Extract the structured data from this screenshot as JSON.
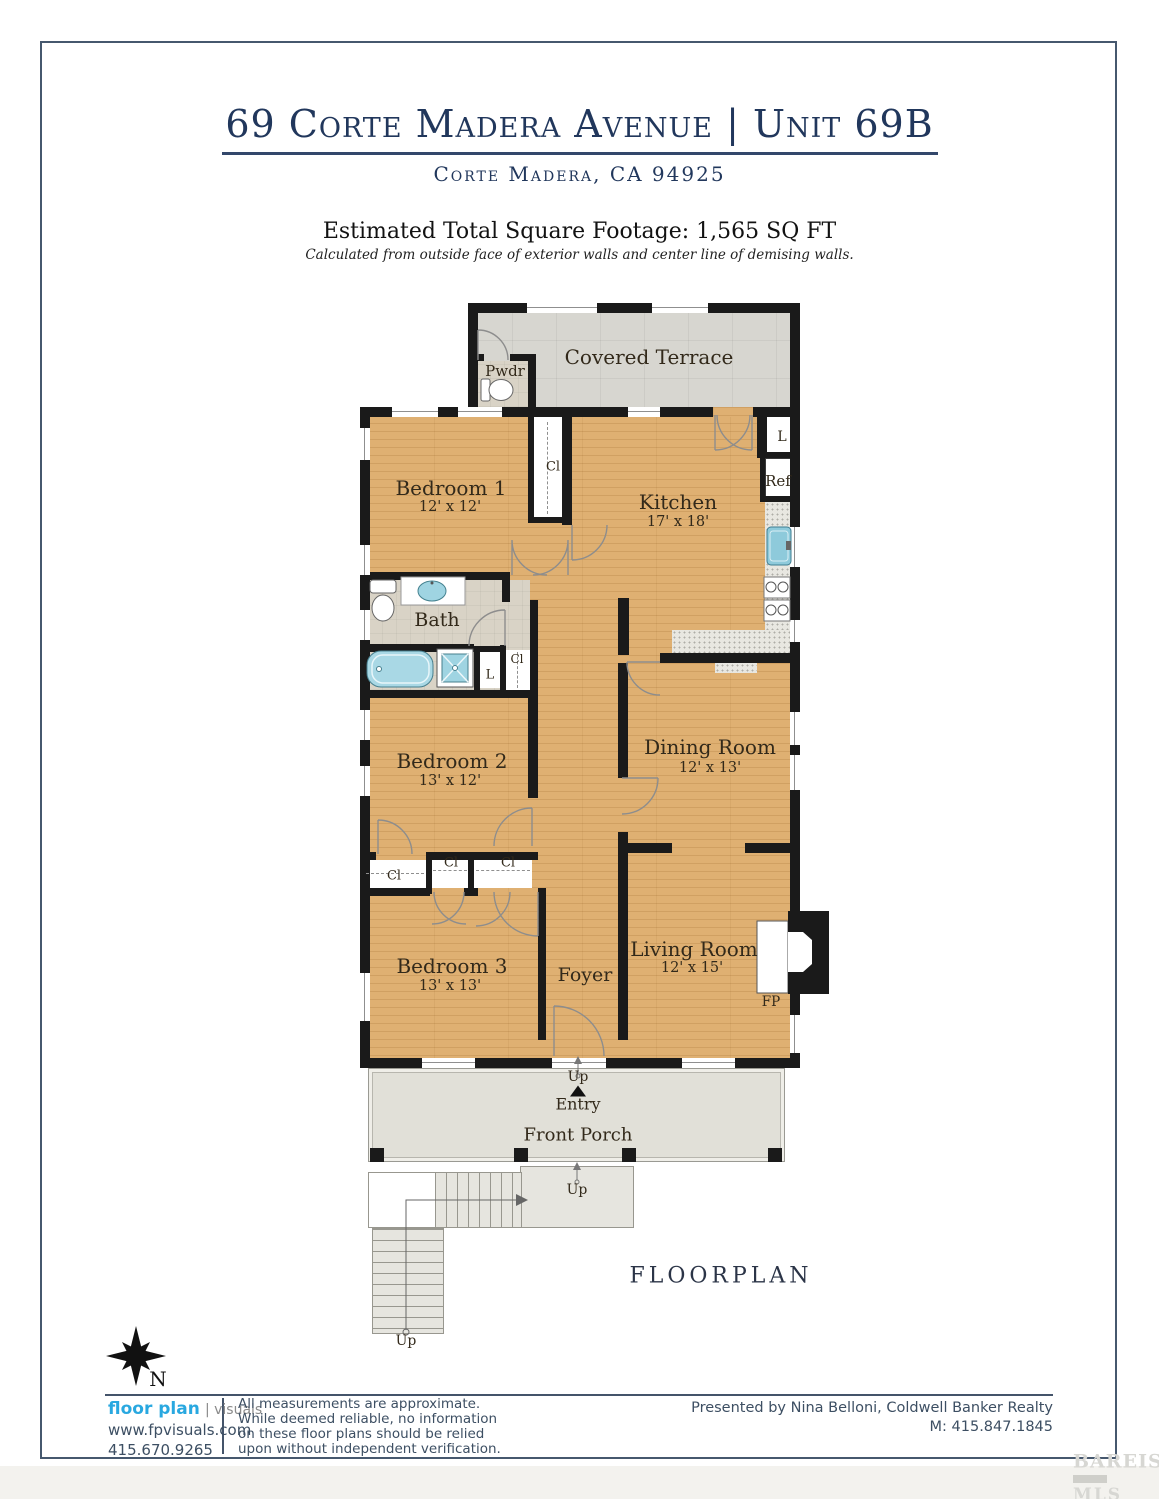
{
  "header": {
    "title": "69 Corte Madera Avenue | Unit 69B",
    "subtitle": "Corte Madera, CA 94925",
    "sqft_line": "Estimated Total Square Footage: 1,565 SQ FT",
    "sqft_note": "Calculated from outside face of exterior walls and center line of demising walls."
  },
  "plan": {
    "rooms": {
      "covered_terrace": {
        "name": "Covered Terrace"
      },
      "pwdr": {
        "name": "Pwdr"
      },
      "bedroom1": {
        "name": "Bedroom 1",
        "dims": "12' x 12'"
      },
      "kitchen": {
        "name": "Kitchen",
        "dims": "17' x 18'"
      },
      "bath": {
        "name": "Bath"
      },
      "bedroom2": {
        "name": "Bedroom 2",
        "dims": "13' x 12'"
      },
      "dining_room": {
        "name": "Dining Room",
        "dims": "12' x 13'"
      },
      "bedroom3": {
        "name": "Bedroom 3",
        "dims": "13' x 13'"
      },
      "foyer": {
        "name": "Foyer"
      },
      "living_room": {
        "name": "Living Room",
        "dims": "12' x 15'"
      },
      "front_porch": {
        "name": "Front Porch"
      }
    },
    "small_labels": {
      "closet": "Cl",
      "linen": "L",
      "refrigerator": "Ref",
      "fireplace": "FP",
      "up": "Up",
      "entry": "Entry"
    },
    "caption": "FLOORPLAN",
    "compass_north": "N",
    "colors": {
      "wood_floor": "#dfb072",
      "terrace_tile": "#d7d6d0",
      "bath_tile": "#d9d3c6",
      "fixture_blue": "#9fd4e2",
      "wall": "#1a1a1a"
    }
  },
  "footer": {
    "brand": {
      "name_bold": "floor plan",
      "name_light": "visuals",
      "website": "www.fpvisuals.com",
      "phone": "415.670.9265",
      "brand_blue": "#29a8e0"
    },
    "disclaimer": [
      "All measurements are approximate.",
      "While deemed reliable, no information",
      "on these floor plans should be relied",
      "upon without independent verification."
    ],
    "presented_by": "Presented by Nina Belloni, Coldwell Banker Realty",
    "presented_phone": "M: 415.847.1845"
  },
  "watermark": {
    "line1": "BAREIS",
    "reg": "®",
    "line2": "MLS"
  }
}
